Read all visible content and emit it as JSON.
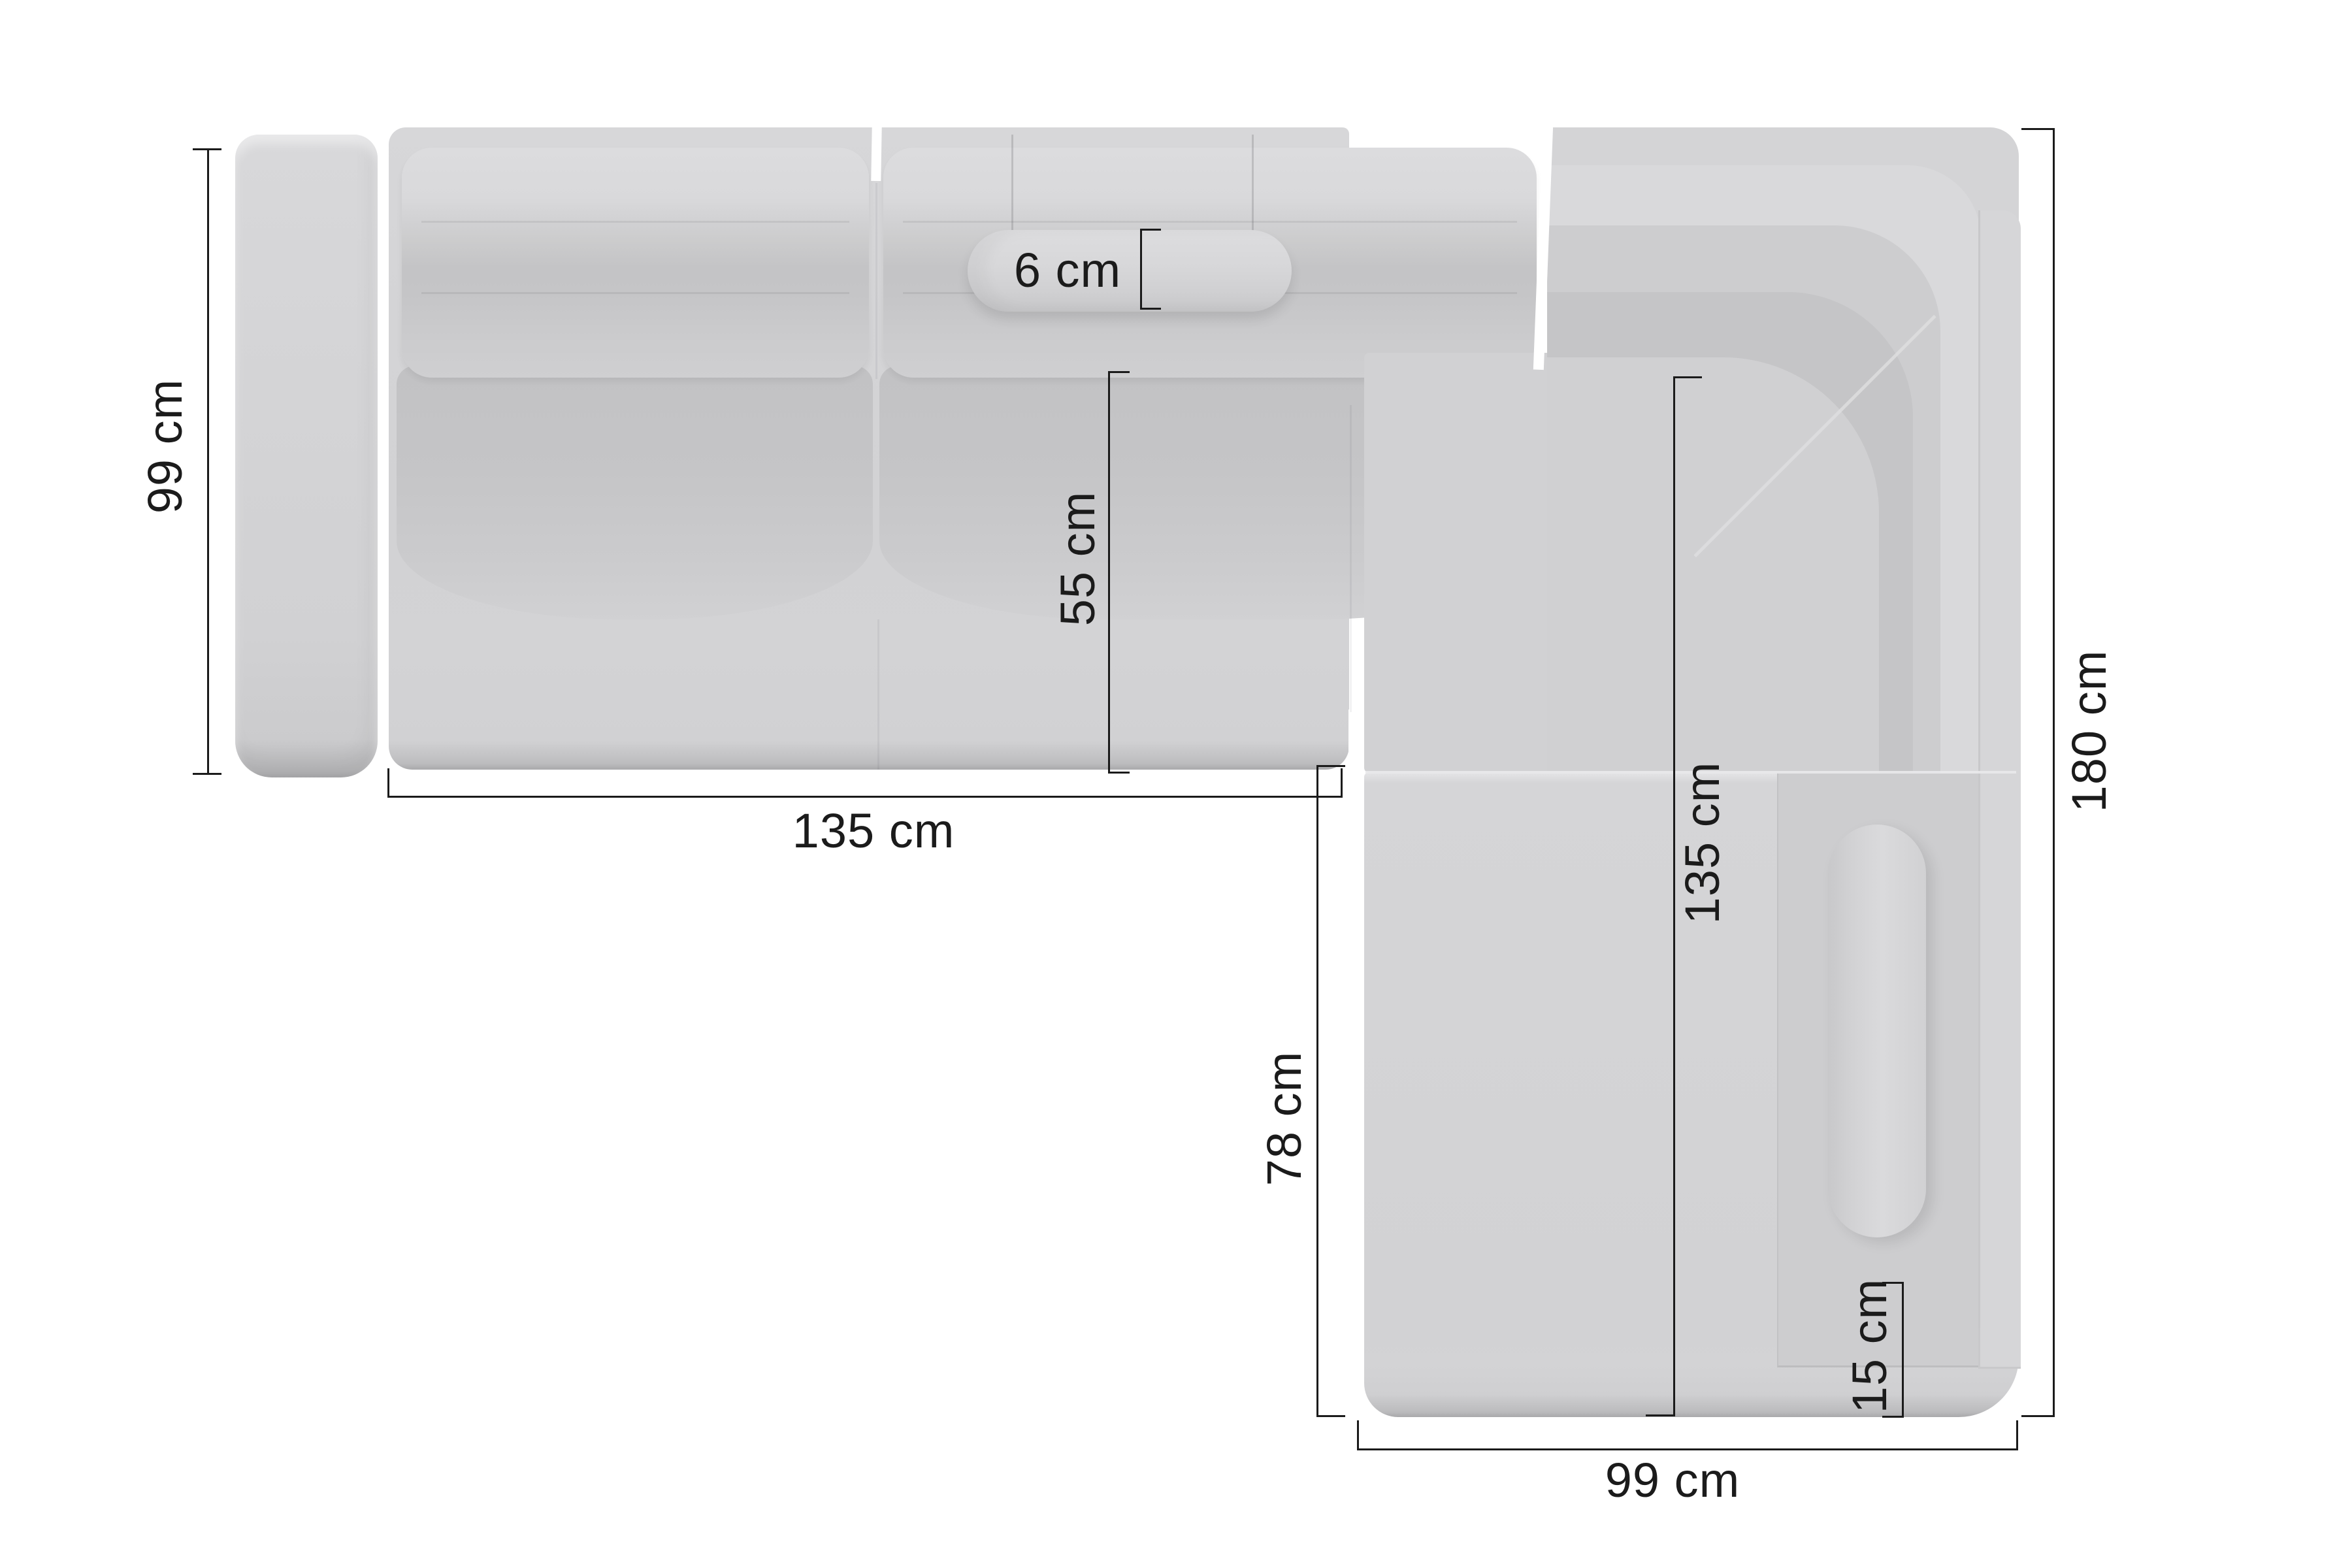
{
  "diagram": {
    "subject": "corner-sofa-top-view",
    "unit": "cm",
    "colors": {
      "background": "#ffffff",
      "dimension_line": "#1b1b1b",
      "dimension_text": "#1b1b1b",
      "sofa_light": "#d9d9db",
      "sofa_base": "#d3d3d5",
      "sofa_shade": "#c5c5c7"
    },
    "dimensions": {
      "left_height": "99 cm",
      "bottom_left_width": "135 cm",
      "pillow_height": "6 cm",
      "seat_depth": "55 cm",
      "right_inner_length": "135 cm",
      "front_inner_length": "78 cm",
      "corner_trim": "15 cm",
      "right_total_length": "180 cm",
      "bottom_right_width": "99 cm"
    }
  }
}
